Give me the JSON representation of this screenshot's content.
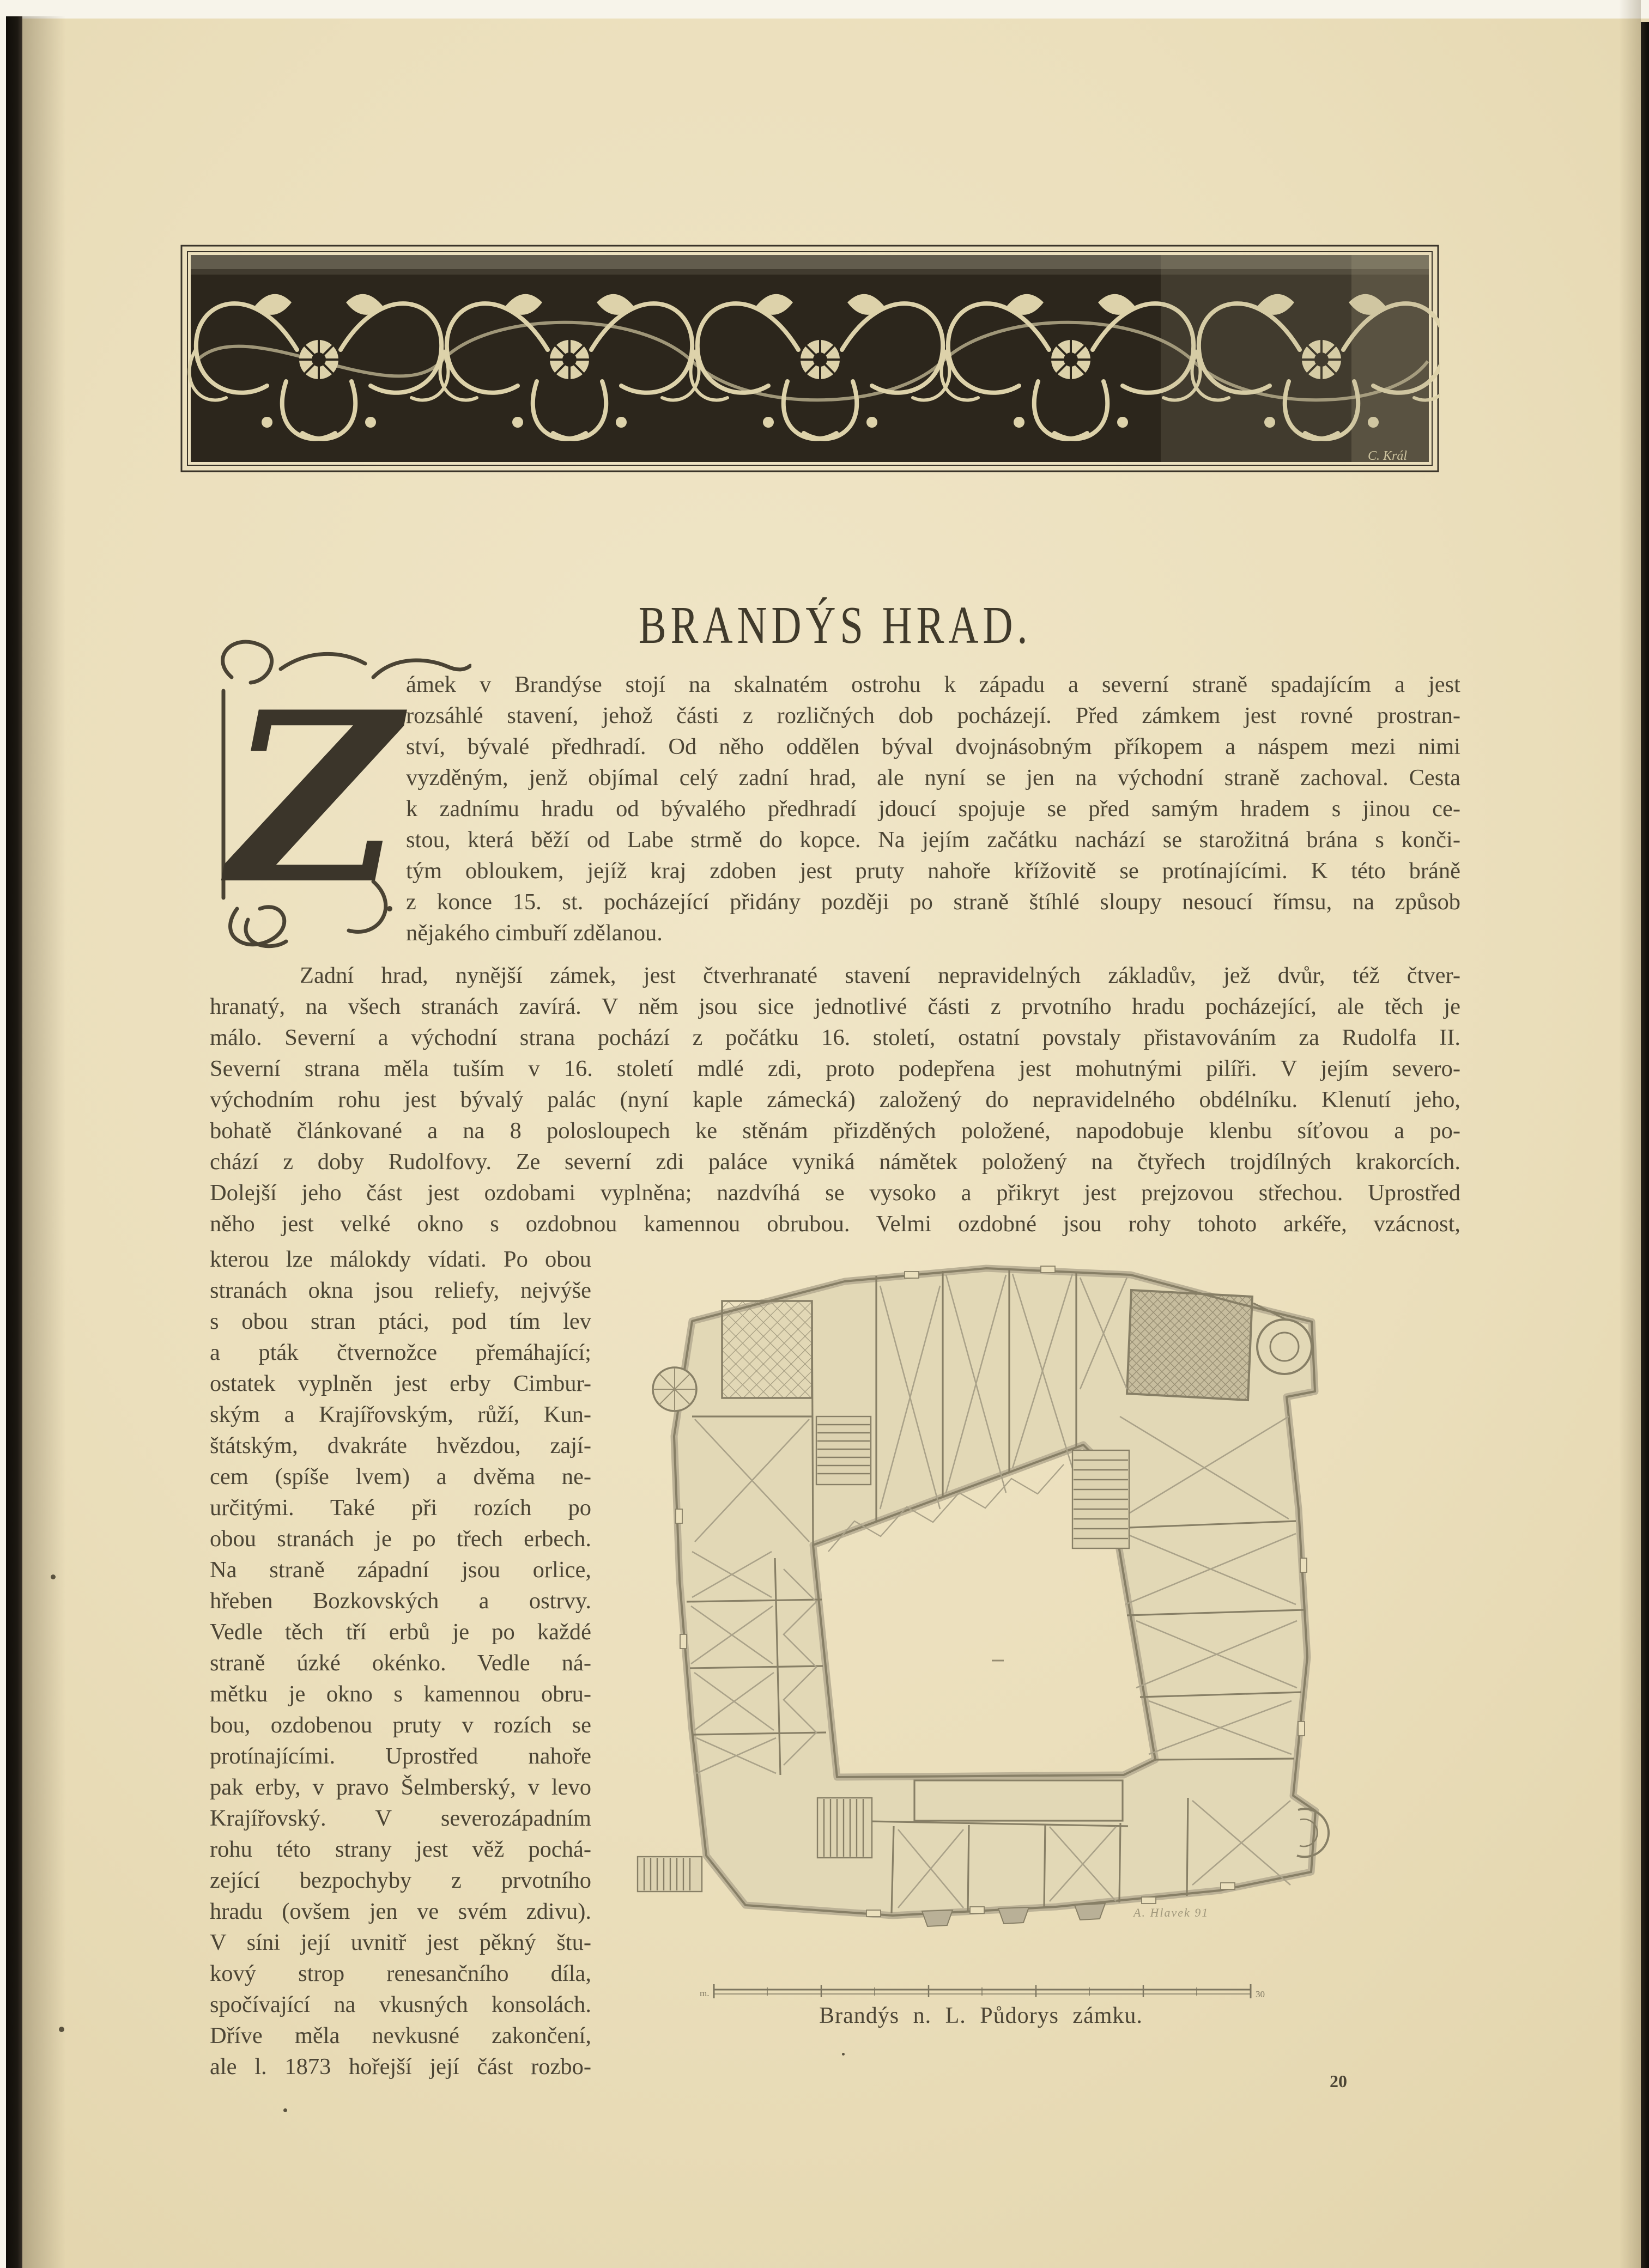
{
  "page": {
    "title": "BRANDÝS HRAD.",
    "drop_cap": "Z",
    "page_number": "20",
    "paper_color": "#ebdfbc",
    "ink_color": "#4c4535",
    "ornament_field_color": "#2c261c",
    "plan_line_color": "#8a8268"
  },
  "ornament": {
    "signature": "C. Král"
  },
  "paragraph1_lines": [
    "ámek v Brandýse stojí na skalnatém ostrohu k západu a severní straně spadajícím a jest",
    "rozsáhlé stavení, jehož části z rozličných dob pocházejí. Před zámkem jest rovné prostran-",
    "ství, bývalé předhradí. Od něho oddělen býval dvojnásobným příkopem a náspem mezi nimi",
    "vyzděným, jenž objímal celý zadní hrad, ale nyní se jen na východní straně zachoval. Cesta",
    "k zadnímu hradu od bývalého předhradí jdoucí spojuje se před samým hradem s jinou ce-",
    "stou, která běží od Labe strmě do kopce. Na jejím začátku nachází se starožitná brána s konči-",
    "tým obloukem, jejíž kraj zdoben jest pruty nahoře křížovitě se protínajícími. K této bráně",
    "z konce 15. st. pocházející přidány později po straně štíhlé sloupy nesoucí římsu, na způsob",
    "nějakého cimbuří zdělanou."
  ],
  "paragraph2_lines": [
    "Zadní hrad, nynější zámek, jest čtverhranaté stavení nepravidelných základův, jež dvůr, též čtver-",
    "hranatý, na všech stranách zavírá. V něm jsou sice jednotlivé části z prvotního hradu pocházející, ale těch je",
    "málo. Severní a východní strana pochází z počátku 16. století, ostatní povstaly přistavováním za Rudolfa II.",
    "Severní strana měla tuším v 16. století mdlé zdi, proto podepřena jest mohutnými pilíři. V jejím severo-",
    "východním rohu jest bývalý palác (nyní kaple zámecká) založený do nepravidelného obdélníku. Klenutí jeho,",
    "bohatě článkované a na 8 polosloupech ke stěnám přizděných položené, napodobuje klenbu síťovou a po-",
    "chází z doby Rudolfovy. Ze severní zdi paláce vyniká námětek položený na čtyřech trojdílných krakorcích.",
    "Dolejší jeho část jest ozdobami vyplněna; nazdvíhá se vysoko a přikryt jest prejzovou střechou. Uprostřed",
    "něho jest velké okno s ozdobnou kamennou obrubou.  Velmi ozdobné jsou rohy tohoto arkéře, vzácnost,"
  ],
  "left_column_lines": [
    "kterou lze málokdy vídati. Po obou",
    "stranách okna jsou reliefy, nejvýše",
    "s obou stran ptáci, pod tím lev",
    "a pták čtvernožce přemáhající;",
    "ostatek vyplněn jest erby Cimbur-",
    "ským a Krajířovským, růží, Kun-",
    "štátským, dvakráte hvězdou, zají-",
    "cem (spíše lvem) a dvěma ne-",
    "určitými. Také při rozích po",
    "obou stranách je po třech erbech.",
    "Na straně západní jsou orlice,",
    "hřeben Bozkovských a ostrvy.",
    "Vedle těch tří erbů je po každé",
    "straně úzké okénko. Vedle ná-",
    "mětku je okno s kamennou obru-",
    "bou, ozdobenou pruty v rozích se",
    "protínajícími. Uprostřed nahoře",
    "pak erby, v pravo Šelmberský, v levo",
    "Krajířovský. V severozápadním",
    "rohu této strany jest věž pochá-",
    "zející bezpochyby z prvotního",
    "hradu (ovšem jen ve svém zdivu).",
    "V síni její uvnitř jest pěkný štu-",
    "kový strop renesančního díla,",
    "spočívající na vkusných konsolách.",
    "Dříve měla nevkusné zakončení,",
    "ale l. 1873 hořejší její část rozbo-"
  ],
  "figure": {
    "caption": "Brandýs n. L. Půdorys zámku.",
    "plan_signature": "A. Hlavek 91",
    "scale_left_label": "m.",
    "scale_right_label": "30"
  }
}
